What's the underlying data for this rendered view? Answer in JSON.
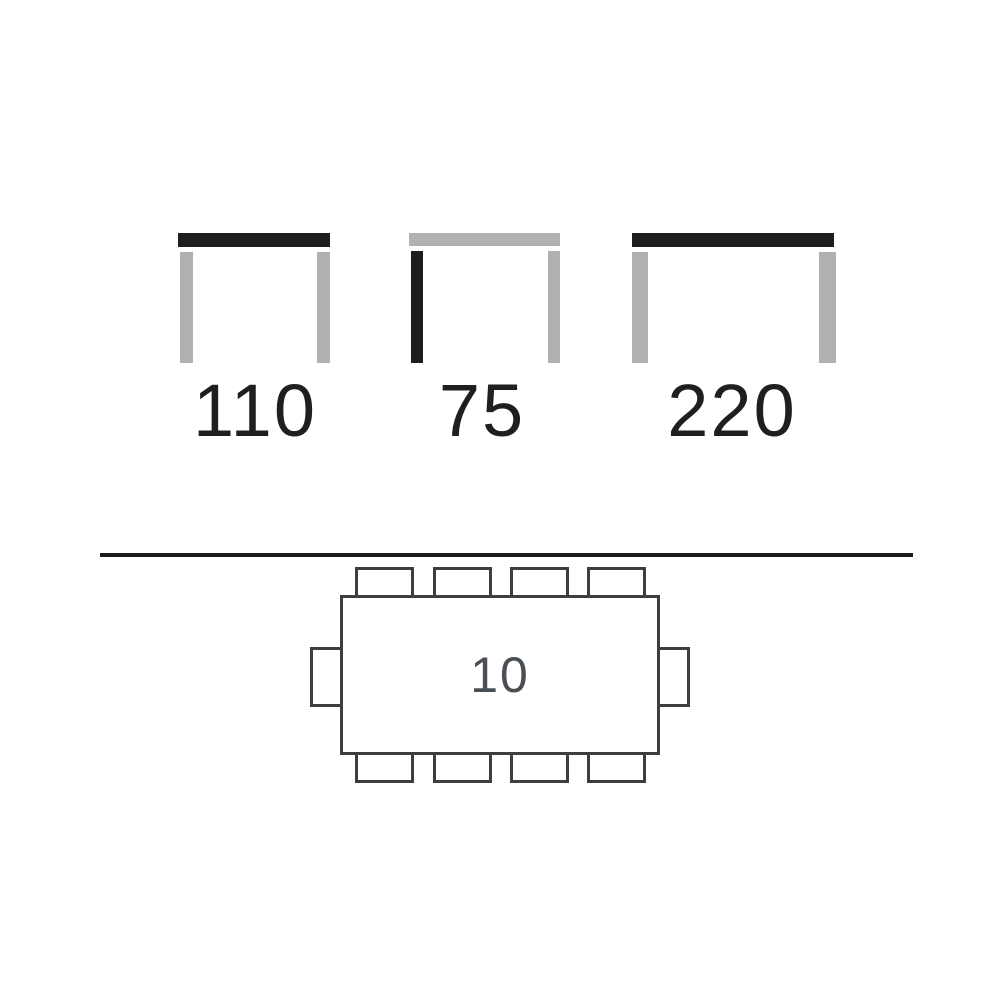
{
  "page": {
    "background": "#ffffff"
  },
  "colors": {
    "highlight_black": "#1d1d1b",
    "neutral_gray": "#b1b1b1",
    "plan_outline": "#3e3e3e",
    "dimension_label_text": "#1f1f1f",
    "seat_count_text": "#4a4f55",
    "divider": "#1c1c1c"
  },
  "dimension_views": [
    {
      "label": "110",
      "highlighted_part": "tabletop",
      "tabletop_color": "black",
      "left_leg_color": "gray",
      "right_leg_color": "gray"
    },
    {
      "label": "75",
      "highlighted_part": "left-leg",
      "tabletop_color": "gray",
      "left_leg_color": "black",
      "right_leg_color": "gray"
    },
    {
      "label": "220",
      "highlighted_part": "tabletop",
      "tabletop_color": "black",
      "left_leg_color": "gray",
      "right_leg_color": "gray"
    }
  ],
  "plan_view": {
    "seat_count": "10",
    "chairs": {
      "top": 4,
      "bottom": 4,
      "left": 1,
      "right": 1
    }
  }
}
